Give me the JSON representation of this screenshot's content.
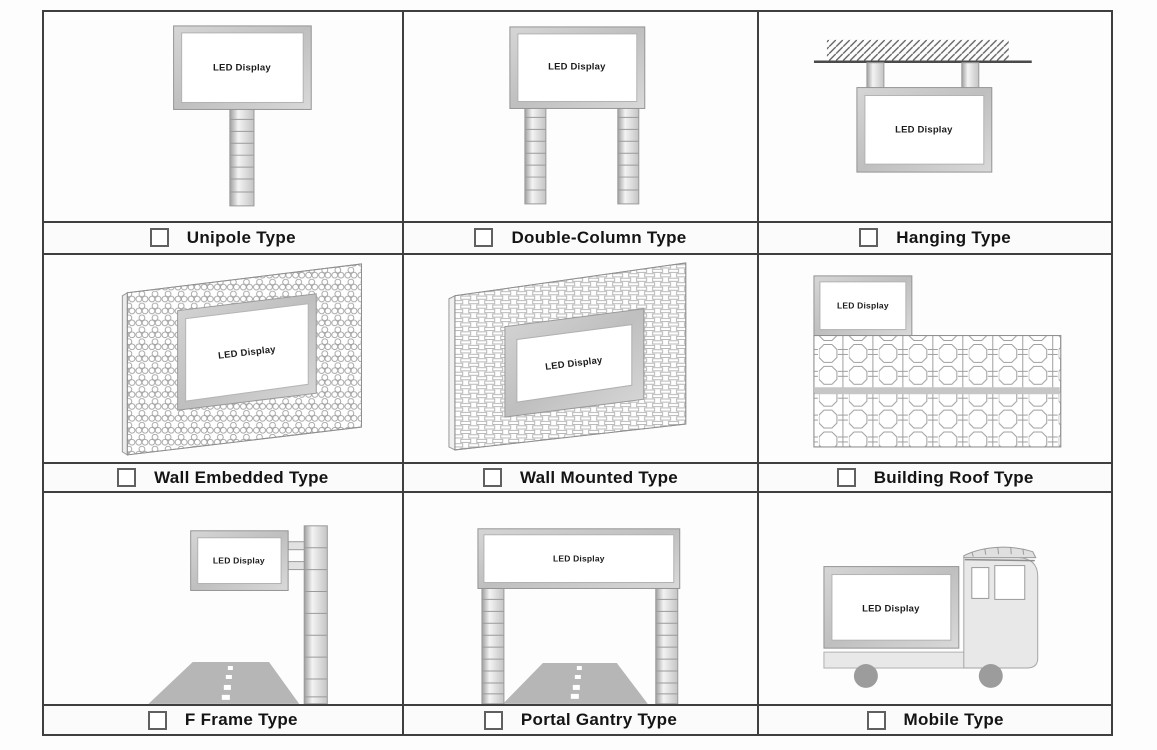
{
  "cells": [
    {
      "id": "unipole",
      "screen": "LED Display",
      "label": "Unipole Type",
      "checked": false
    },
    {
      "id": "double-column",
      "screen": "LED Display",
      "label": "Double-Column Type",
      "checked": false
    },
    {
      "id": "hanging",
      "screen": "LED Display",
      "label": "Hanging Type",
      "checked": false
    },
    {
      "id": "wall-embedded",
      "screen": "LED Display",
      "label": "Wall Embedded Type",
      "checked": false
    },
    {
      "id": "wall-mounted",
      "screen": "LED Display",
      "label": "Wall Mounted Type",
      "checked": false
    },
    {
      "id": "building-roof",
      "screen": "LED Display",
      "label": "Building Roof Type",
      "checked": false
    },
    {
      "id": "f-frame",
      "screen": "LED Display",
      "label": "F Frame Type",
      "checked": false
    },
    {
      "id": "portal-gantry",
      "screen": "LED Display",
      "label": "Portal Gantry Type",
      "checked": false
    },
    {
      "id": "mobile",
      "screen": "LED Display",
      "label": "Mobile Type",
      "checked": false
    }
  ],
  "colors": {
    "grid_line": "#3f3f3f",
    "background": "#fdfdfd",
    "frame_silver": "#c6c6c6",
    "road_gray": "#b6b6b6",
    "wheel_gray": "#9c9c9c",
    "label_text": "#141414"
  }
}
